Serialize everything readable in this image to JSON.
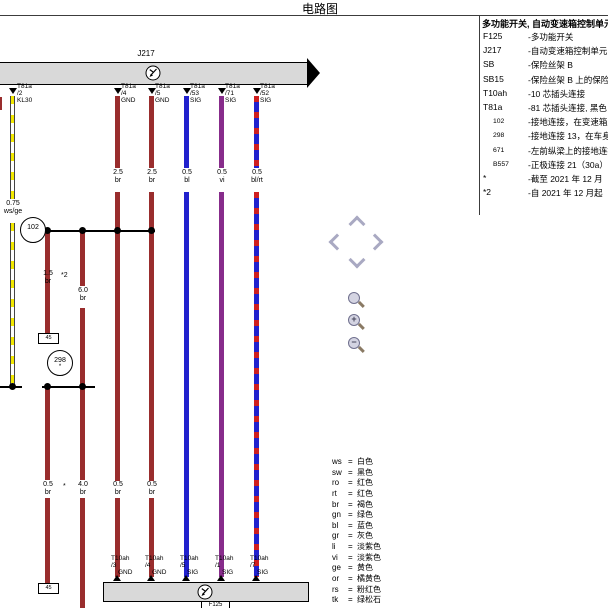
{
  "title": "电路图",
  "component_legend": {
    "header": "多功能开关, 自动变速箱控制单元",
    "items": [
      {
        "code": "F125",
        "desc": "-多功能开关",
        "small": false
      },
      {
        "code": "J217",
        "desc": "-自动变速箱控制单元",
        "small": false
      },
      {
        "code": "SB",
        "desc": "-保险丝架 B",
        "small": false
      },
      {
        "code": "SB15",
        "desc": "-保险丝架 B 上的保险丝",
        "small": false
      },
      {
        "code": "T10ah",
        "desc": "-10 芯插头连接",
        "small": false
      },
      {
        "code": "T81a",
        "desc": "-81 芯插头连接, 黑色",
        "small": false
      },
      {
        "code": "102",
        "desc": "-接地连接，在变速箱上",
        "small": true
      },
      {
        "code": "298",
        "desc": "-接地连接 13，在车身",
        "small": true
      },
      {
        "code": "671",
        "desc": "-左前纵梁上的接地连接",
        "small": true
      },
      {
        "code": "B557",
        "desc": "-正极连接 21（30a）",
        "small": true
      },
      {
        "code": "*",
        "desc": "-截至 2021 年 12 月",
        "small": false
      },
      {
        "code": "*2",
        "desc": "-自 2021 年 12 月起",
        "small": false
      }
    ]
  },
  "color_legend": {
    "separator": "=",
    "items": [
      {
        "code": "ws",
        "name": "白色"
      },
      {
        "code": "sw",
        "name": "黑色"
      },
      {
        "code": "ro",
        "name": "红色"
      },
      {
        "code": "rt",
        "name": "红色"
      },
      {
        "code": "br",
        "name": "褐色"
      },
      {
        "code": "gn",
        "name": "绿色"
      },
      {
        "code": "bl",
        "name": "蓝色"
      },
      {
        "code": "gr",
        "name": "灰色"
      },
      {
        "code": "li",
        "name": "淡紫色"
      },
      {
        "code": "vi",
        "name": "淡紫色"
      },
      {
        "code": "ge",
        "name": "黄色"
      },
      {
        "code": "or",
        "name": "橘黄色"
      },
      {
        "code": "rs",
        "name": "粉红色"
      },
      {
        "code": "tk",
        "name": "绿松石"
      }
    ]
  },
  "diagram": {
    "top_component_label": "J217",
    "bottom_component_label": "F125",
    "ground_102": "102",
    "ground_298": "298",
    "ground_298_note": "*",
    "continuation_top": "45",
    "continuation_bottom": "45",
    "top_pins": [
      {
        "t": "T81a",
        "pin": "/2",
        "fn": "KL30"
      },
      {
        "t": "T81a",
        "pin": "/4",
        "fn": "GND"
      },
      {
        "t": "T81a",
        "pin": "/5",
        "fn": "GND"
      },
      {
        "t": "T81a",
        "pin": "/53",
        "fn": "SIG"
      },
      {
        "t": "T81a",
        "pin": "/71",
        "fn": "SIG"
      },
      {
        "t": "T81a",
        "pin": "/52",
        "fn": "SIG"
      }
    ],
    "bottom_pins": [
      {
        "t": "T10ah",
        "pin": "/3",
        "fn": "GND"
      },
      {
        "t": "T10ah",
        "pin": "/4",
        "fn": "GND"
      },
      {
        "t": "T10ah",
        "pin": "/5",
        "fn": "SIG"
      },
      {
        "t": "T10ah",
        "pin": "/1",
        "fn": "SIG"
      },
      {
        "t": "T10ah",
        "pin": "/7",
        "fn": "SIG"
      }
    ],
    "gauge_labels": [
      {
        "size": "0.75",
        "color": "ws/ge"
      },
      {
        "size": "2.5",
        "color": "br"
      },
      {
        "size": "2.5",
        "color": "br"
      },
      {
        "size": "0.5",
        "color": "bl"
      },
      {
        "size": "0.5",
        "color": "vi"
      },
      {
        "size": "0.5",
        "color": "bl/rt"
      },
      {
        "size": "1.5",
        "color": "br",
        "note": "*2"
      },
      {
        "size": "6.0",
        "color": "br"
      },
      {
        "size": "0.5",
        "color": "br",
        "note": "*"
      },
      {
        "size": "4.0",
        "color": "br"
      },
      {
        "size": "0.5",
        "color": "br"
      },
      {
        "size": "0.5",
        "color": "br"
      }
    ],
    "wire_palette": {
      "br": "#992d2d",
      "bl": "#2121cd",
      "vi": "#872c8b",
      "ge": "#f2e800",
      "rt": "#cf1f1f"
    }
  },
  "controls": {
    "zoom_plus": "+",
    "zoom_minus": "−"
  }
}
